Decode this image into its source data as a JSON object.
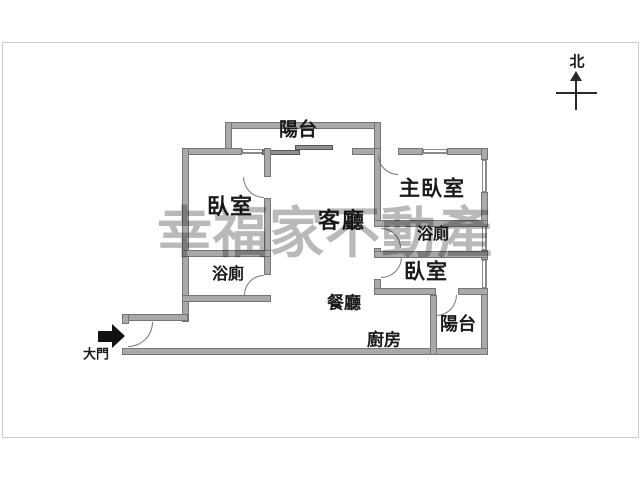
{
  "plan_title": "apartment-floor-plan",
  "compass": {
    "north_label": "北"
  },
  "watermark": {
    "text": "幸福家不動產"
  },
  "entry": {
    "label": "大門"
  },
  "rooms": {
    "balcony_top": {
      "label": "陽台"
    },
    "bedroom_left": {
      "label": "臥室"
    },
    "living_room": {
      "label": "客廳"
    },
    "master_bedroom": {
      "label": "主臥室"
    },
    "bathroom_right": {
      "label": "浴廁"
    },
    "bedroom_right": {
      "label": "臥室"
    },
    "bathroom_left": {
      "label": "浴廁"
    },
    "dining_room": {
      "label": "餐廳"
    },
    "kitchen": {
      "label": "廚房"
    },
    "balcony_bottom": {
      "label": "陽台"
    }
  },
  "colors": {
    "wall_fill": "#a9a9a9",
    "wall_outline": "#757575",
    "watermark": "#8a8a8a",
    "label": "#1a1a1a",
    "frame": "#cccccc"
  }
}
